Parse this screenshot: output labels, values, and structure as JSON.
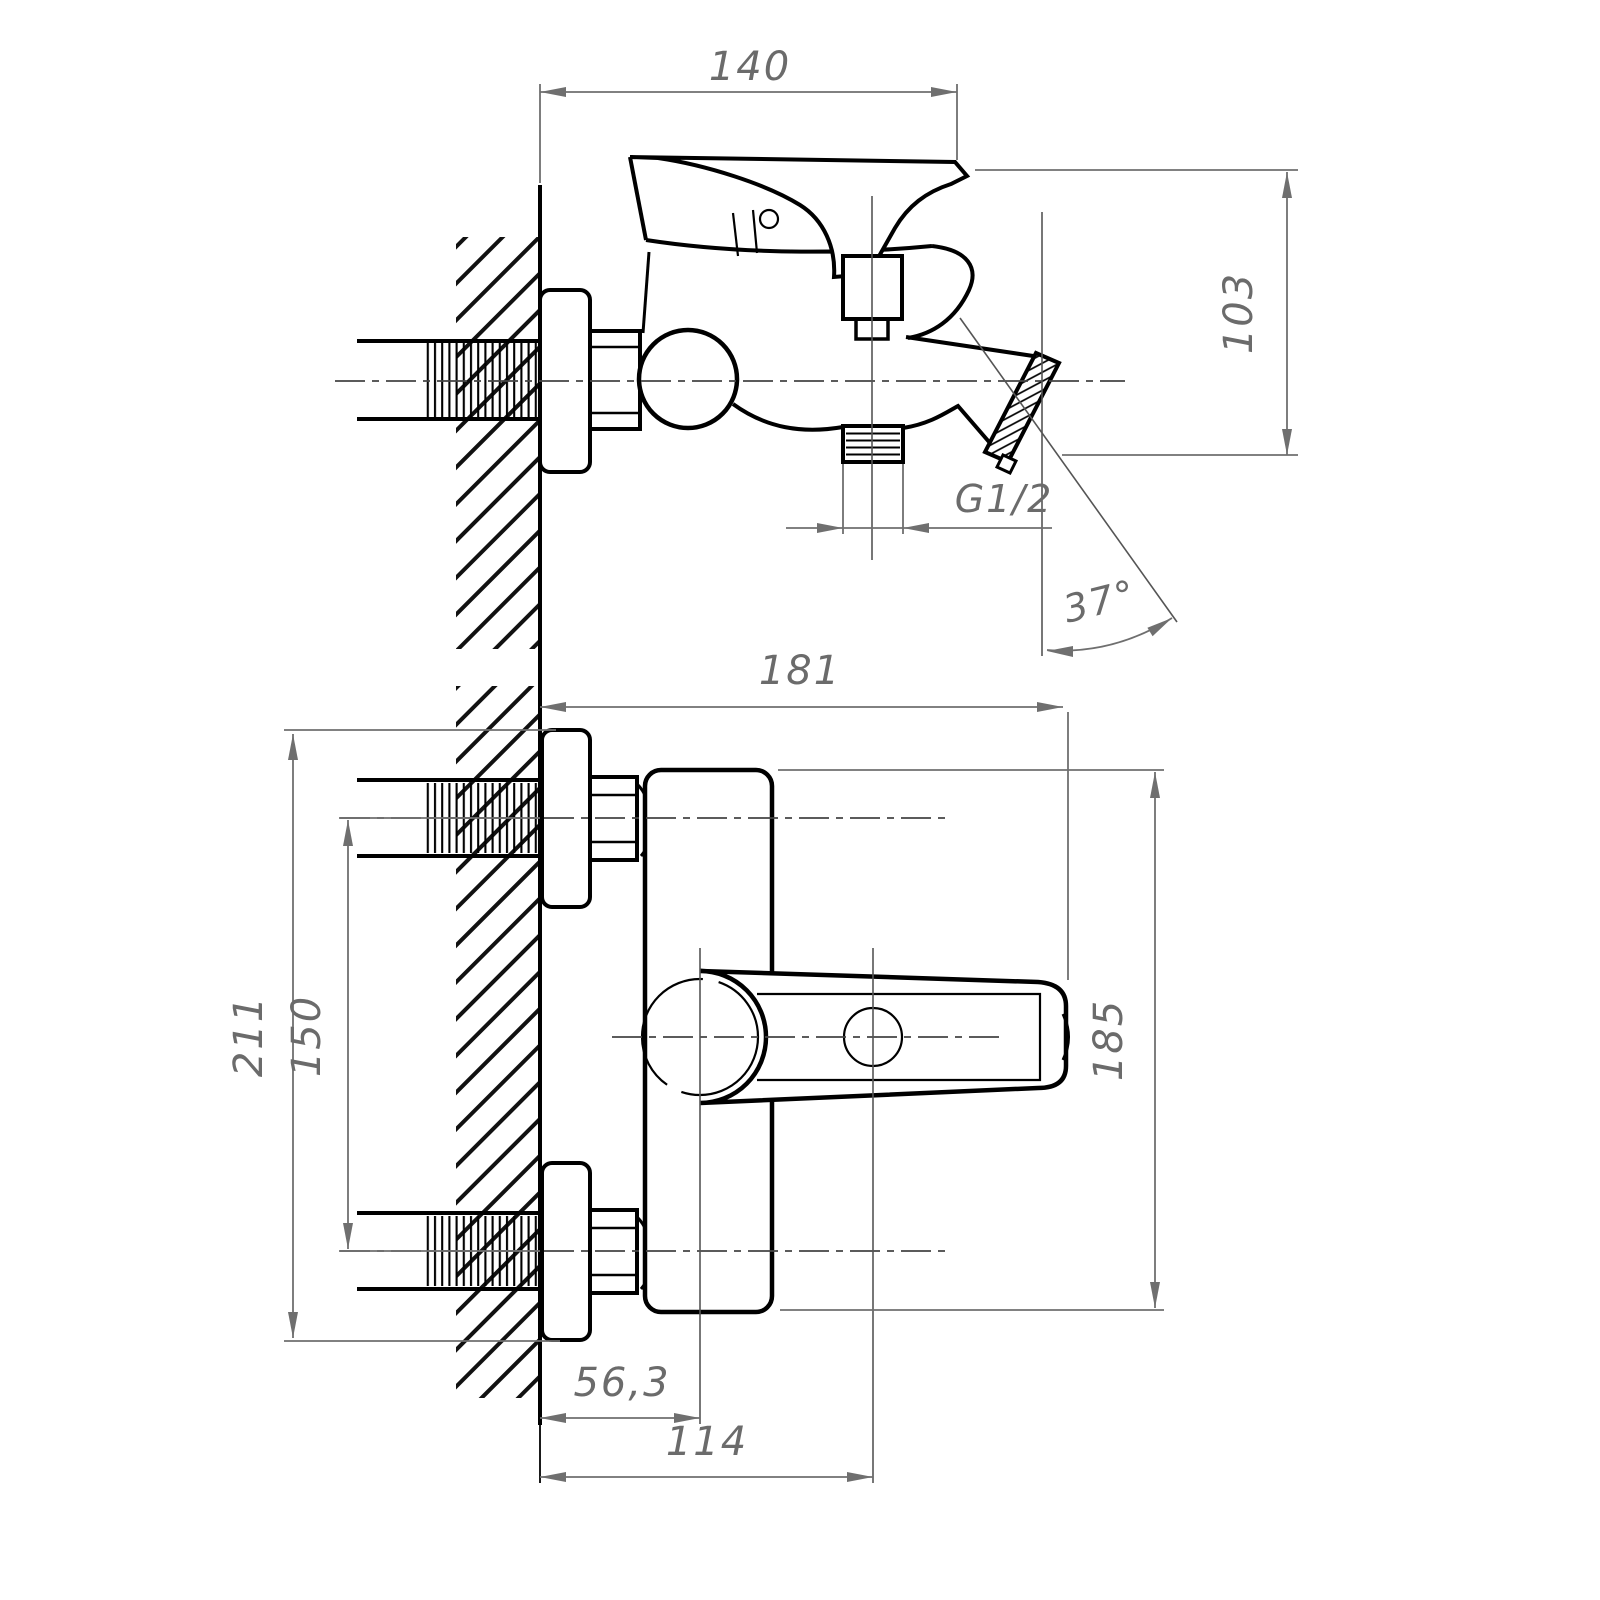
{
  "drawing": {
    "dimensions": {
      "spout_reach": "140",
      "spout_height": "103",
      "thread_size": "G1/2",
      "spout_angle": "37°",
      "overall_width": "181",
      "mounting_height": "211",
      "inlet_spacing": "150",
      "body_height": "185",
      "handle_center_offset": "56,3",
      "diverter_center_offset": "114"
    },
    "colors": {
      "object_line": "#000000",
      "dimension_line": "#6f6f6f",
      "centerline": "#444444",
      "background": "#ffffff"
    }
  }
}
